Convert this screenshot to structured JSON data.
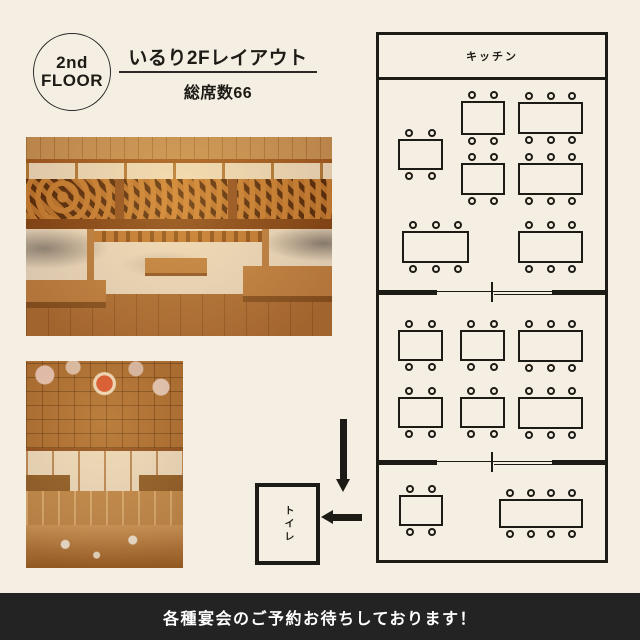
{
  "colors": {
    "background": "#f5eee2",
    "ink": "#1d1b16",
    "footer_bg": "#232323",
    "footer_text": "#ffffff"
  },
  "badge": {
    "line1": "2nd",
    "line2": "FLOOR"
  },
  "header": {
    "title": "いるり2Fレイアウト",
    "seats_label": "総席数66"
  },
  "floorplan": {
    "kitchen_label": "キッチン",
    "toilet_label": "トイレ",
    "tables": [
      {
        "x": 19,
        "y": 104,
        "w": 45,
        "h": 31,
        "seats_per_side": 2
      },
      {
        "x": 82,
        "y": 66,
        "w": 44,
        "h": 34,
        "seats_per_side": 2
      },
      {
        "x": 139,
        "y": 67,
        "w": 65,
        "h": 32,
        "seats_per_side": 3
      },
      {
        "x": 82,
        "y": 128,
        "w": 44,
        "h": 32,
        "seats_per_side": 2
      },
      {
        "x": 139,
        "y": 128,
        "w": 65,
        "h": 32,
        "seats_per_side": 3
      },
      {
        "x": 23,
        "y": 196,
        "w": 67,
        "h": 32,
        "seats_per_side": 3
      },
      {
        "x": 139,
        "y": 196,
        "w": 65,
        "h": 32,
        "seats_per_side": 3
      },
      {
        "x": 19,
        "y": 295,
        "w": 45,
        "h": 31,
        "seats_per_side": 2
      },
      {
        "x": 81,
        "y": 295,
        "w": 45,
        "h": 31,
        "seats_per_side": 2
      },
      {
        "x": 139,
        "y": 295,
        "w": 65,
        "h": 32,
        "seats_per_side": 3
      },
      {
        "x": 19,
        "y": 362,
        "w": 45,
        "h": 31,
        "seats_per_side": 2
      },
      {
        "x": 81,
        "y": 362,
        "w": 45,
        "h": 31,
        "seats_per_side": 2
      },
      {
        "x": 139,
        "y": 362,
        "w": 65,
        "h": 32,
        "seats_per_side": 3
      },
      {
        "x": 20,
        "y": 460,
        "w": 44,
        "h": 31,
        "seats_per_side": 2
      },
      {
        "x": 120,
        "y": 464,
        "w": 84,
        "h": 29,
        "seats_per_side": 4
      }
    ],
    "dividers": [
      {
        "y": 255
      },
      {
        "y": 425
      }
    ]
  },
  "footer": {
    "message": "各種宴会のご予約お待ちしております！"
  }
}
